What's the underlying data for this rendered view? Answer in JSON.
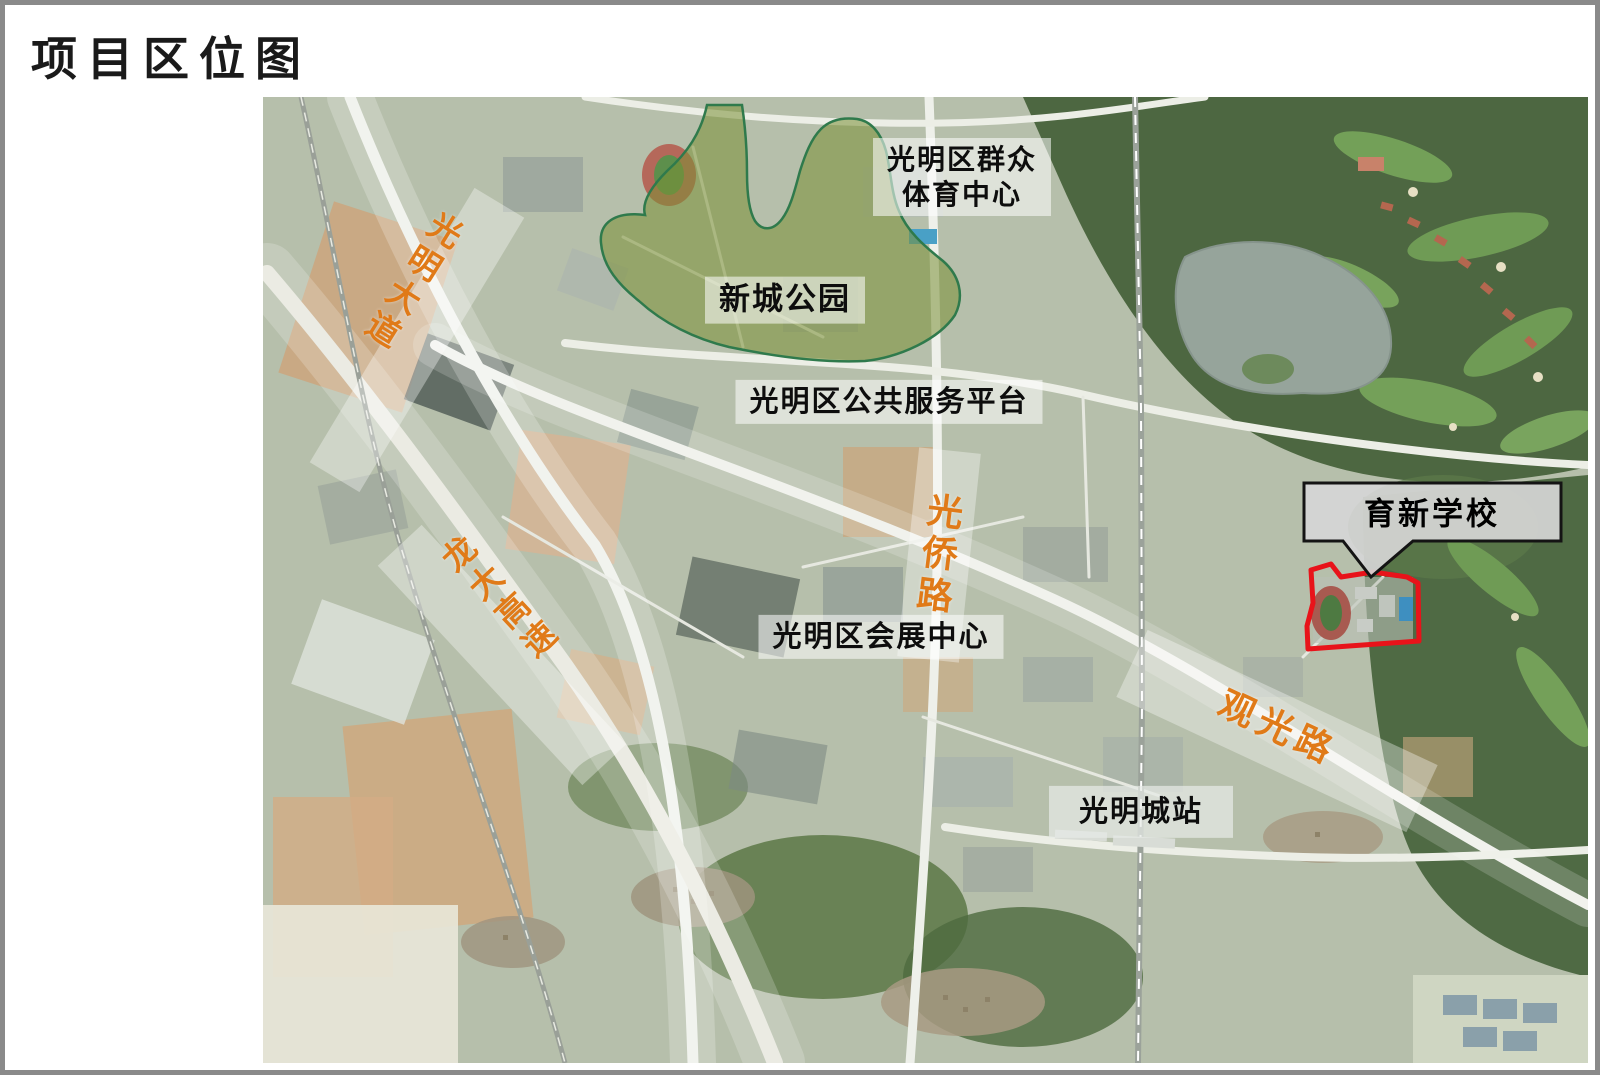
{
  "page": {
    "title": "项目区位图"
  },
  "map": {
    "roads": [
      {
        "id": "guangming-avenue",
        "label": "光明大道"
      },
      {
        "id": "longda-expressway",
        "label": "龙大高速"
      },
      {
        "id": "guangqiao-road",
        "label": "光侨路"
      },
      {
        "id": "guanguang-road",
        "label": "观光路"
      }
    ],
    "places": [
      {
        "id": "sports-center",
        "label": "光明区群众\n体育中心"
      },
      {
        "id": "xincheng-park",
        "label": "新城公园"
      },
      {
        "id": "public-service-platform",
        "label": "光明区公共服务平台"
      },
      {
        "id": "convention-center",
        "label": "光明区会展中心"
      },
      {
        "id": "guangmingcheng-station",
        "label": "光明城站"
      }
    ],
    "site_callout": {
      "label": "育新学校"
    }
  },
  "theme": {
    "road_label_color": "#E07A18",
    "site_outline_color": "#E8131A",
    "park_fill": "rgba(122,143,52,0.55)",
    "park_stroke": "#2F7A4C",
    "callout_fill": "#D6D6D6",
    "callout_border": "#141414",
    "label_bg": "rgba(255,255,255,0.55)",
    "title_color": "#1a1a1a",
    "border_color": "#8a8a8a"
  }
}
